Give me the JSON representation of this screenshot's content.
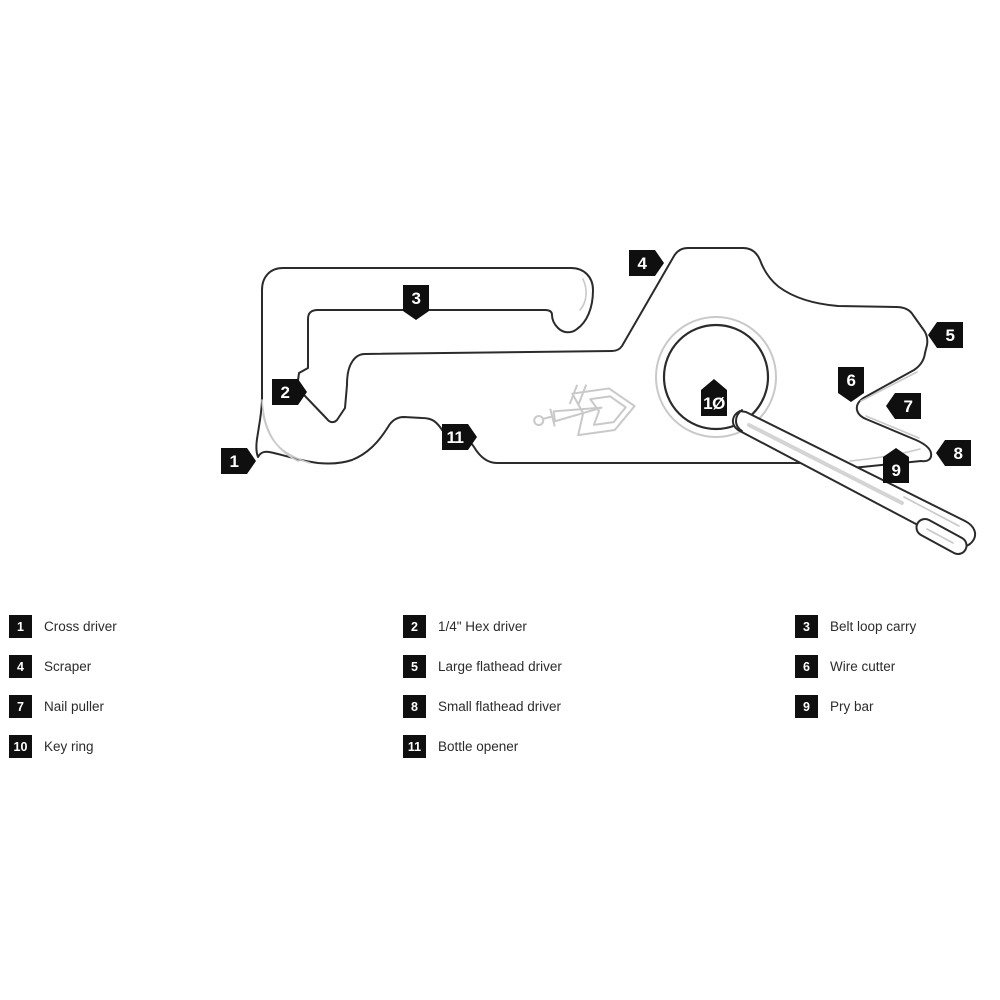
{
  "tools": [
    {
      "num": "1",
      "marker": "1",
      "name": "Cross driver"
    },
    {
      "num": "2",
      "marker": "2",
      "name": "1/4\" Hex driver"
    },
    {
      "num": "3",
      "marker": "3",
      "name": "Belt loop carry"
    },
    {
      "num": "4",
      "marker": "4",
      "name": "Scraper"
    },
    {
      "num": "5",
      "marker": "5",
      "name": "Large flathead driver"
    },
    {
      "num": "6",
      "marker": "6",
      "name": "Wire cutter"
    },
    {
      "num": "7",
      "marker": "7",
      "name": "Nail puller"
    },
    {
      "num": "8",
      "marker": "8",
      "name": "Small flathead driver"
    },
    {
      "num": "9",
      "marker": "9",
      "name": "Pry bar"
    },
    {
      "num": "10",
      "marker": "1Ø",
      "name": "Key ring"
    },
    {
      "num": "11",
      "marker": "11",
      "name": "Bottle opener"
    }
  ],
  "colors": {
    "line": "#2b2b2b",
    "shade": "#c9c9c9",
    "marker_bg": "#0f0f0f",
    "marker_text": "#ffffff",
    "label_text": "#2b2b2b",
    "background": "#ffffff"
  }
}
